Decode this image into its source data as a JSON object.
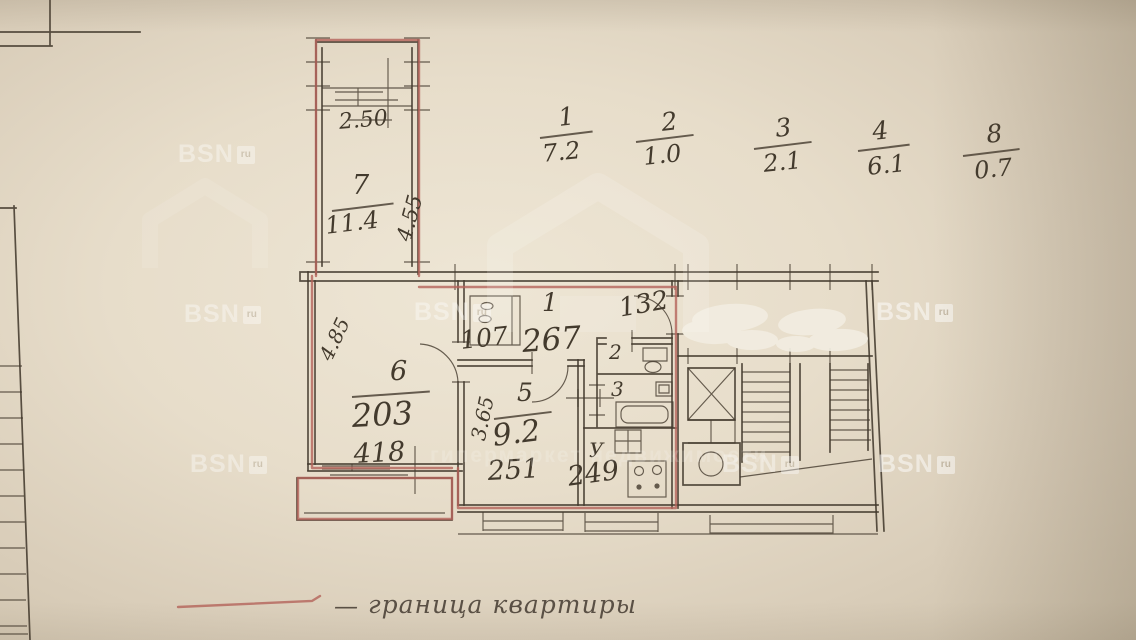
{
  "colors": {
    "paper": "#e9e0cf",
    "ink": "#433a2d",
    "boundary": "#b4635a",
    "legend_text": "#5a5045",
    "watermark": "#ffffff"
  },
  "summary_fractions": [
    {
      "num": "1",
      "den": "7.2"
    },
    {
      "num": "2",
      "den": "1.0"
    },
    {
      "num": "3",
      "den": "2.1"
    },
    {
      "num": "4",
      "den": "6.1"
    },
    {
      "num": "8",
      "den": "0.7"
    }
  ],
  "rooms": {
    "room7": {
      "number": "7",
      "area": "11.4",
      "width": "2.50",
      "depth": "4.55"
    },
    "room6": {
      "number": "6",
      "area": "203",
      "width": "418",
      "diagonal": "4.85"
    },
    "room5": {
      "number": "5",
      "area": "9.2",
      "depth": "3.65",
      "width": "251"
    },
    "hall": {
      "number": "1",
      "closet_width": "107",
      "length": "267",
      "entry_width": "132"
    },
    "wc": {
      "number": "2"
    },
    "bathroom": {
      "number": "3"
    },
    "kitchen": {
      "label": "У",
      "width": "249"
    }
  },
  "legend": {
    "dash": "—",
    "label": "граница квартиры"
  },
  "watermark": {
    "brand": "BSN",
    "suffix": "ru",
    "tagline": "гипермаркет недвижимости"
  }
}
